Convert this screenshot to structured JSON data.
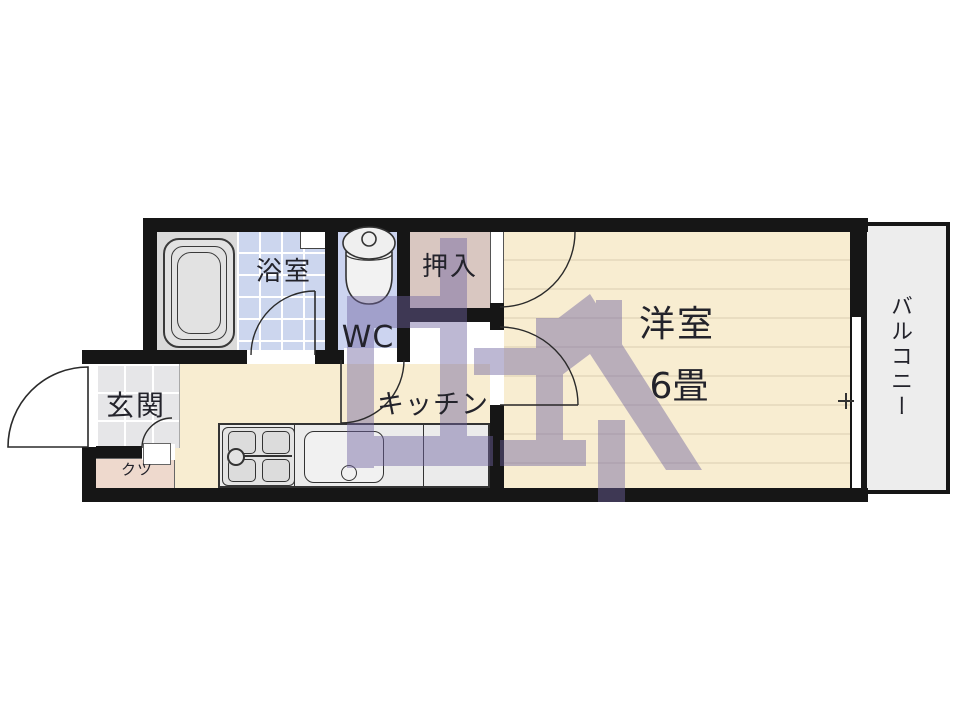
{
  "title": "1K apartment floor plan",
  "rooms": {
    "bath": {
      "label": "浴室"
    },
    "toilet": {
      "label": "WC"
    },
    "closet": {
      "label": "押入"
    },
    "western_room": {
      "label": "洋室",
      "size": "6畳"
    },
    "kitchen": {
      "label": "キッチン"
    },
    "entrance": {
      "label": "玄関"
    },
    "shoe_cabinet": {
      "label": "クツ"
    },
    "balcony": {
      "label": "バルコニー"
    }
  },
  "fixtures": [
    "bathtub",
    "toilet",
    "bath-window",
    "gas-stove",
    "kitchen-sink",
    "sliding-window",
    "entrance-door",
    "watermark-logo"
  ],
  "colors": {
    "wall": "#161616",
    "room_floor": "#f8edd1",
    "floor_line": "#e9ddc1",
    "bath_tile": "#ccd6ee",
    "wc_floor": "#ccd4f0",
    "closet_floor": "#d9c7c1",
    "entrance_tile": "#e6e6e8",
    "shoe_box": "#eed9cd",
    "balcony_floor": "#ededed",
    "watermark": "#6f63a0",
    "text": "#23232b"
  }
}
